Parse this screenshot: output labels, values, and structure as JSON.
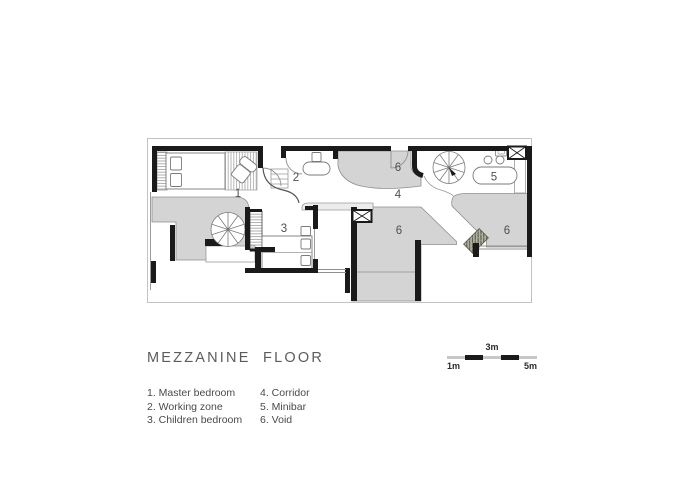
{
  "title": "MEZZANINE  FLOOR",
  "legend": {
    "column1": [
      {
        "label": "1. Master bedroom"
      },
      {
        "label": "2. Working zone"
      },
      {
        "label": "3. Children bedroom"
      }
    ],
    "column2": [
      {
        "label": "4. Corridor"
      },
      {
        "label": "5. Minibar"
      },
      {
        "label": "6. Void"
      }
    ]
  },
  "plan": {
    "labels": [
      {
        "n": "1",
        "room": "master-bedroom"
      },
      {
        "n": "2",
        "room": "working-zone"
      },
      {
        "n": "3",
        "room": "children-bedroom"
      },
      {
        "n": "4",
        "room": "corridor"
      },
      {
        "n": "5",
        "room": "minibar"
      },
      {
        "n": "6",
        "room": "void-upper"
      },
      {
        "n": "6",
        "room": "void-center"
      },
      {
        "n": "6",
        "room": "void-right"
      }
    ]
  },
  "scale_bar": {
    "left_label": "1m",
    "mid_label": "3m",
    "right_label": "5m"
  },
  "colors": {
    "wall": "#1a1a1a",
    "void_fill": "#d4d4d4",
    "thin_line": "#8f8f8f",
    "scale_light": "#c7c7c7",
    "bridge_step_fill": "#b3b3a2",
    "label_text": "#4f4f4f"
  }
}
